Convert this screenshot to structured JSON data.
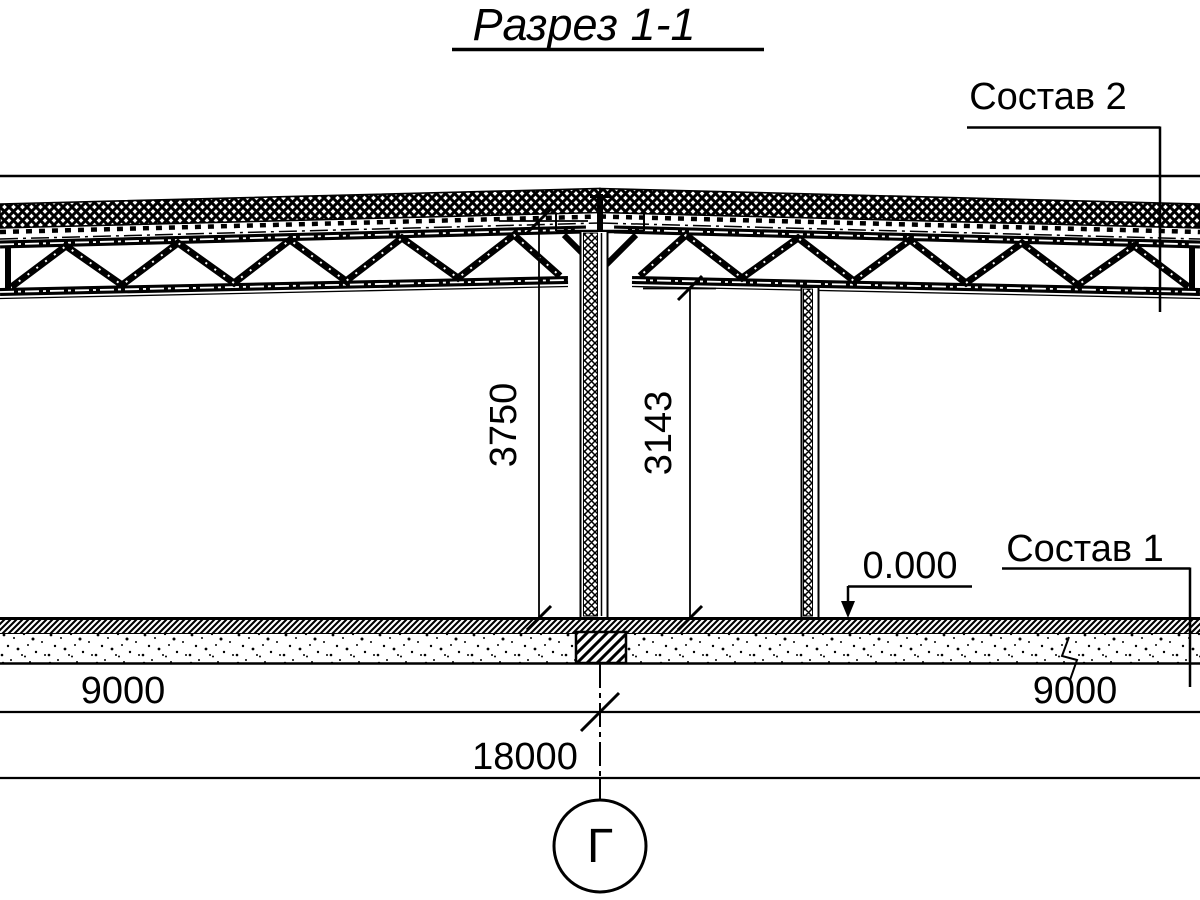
{
  "title": "Разрез 1-1",
  "annotations": {
    "composition_2": "Состав 2",
    "composition_1": "Состав 1",
    "level_mark": "0.000"
  },
  "dimensions": {
    "vertical_ridge": "3750",
    "vertical_clear": "3143",
    "span_left": "9000",
    "span_right": "9000",
    "span_total": "18000"
  },
  "grid_axis_label": "Г",
  "colors": {
    "ink": "#000000",
    "paper": "#ffffff"
  }
}
